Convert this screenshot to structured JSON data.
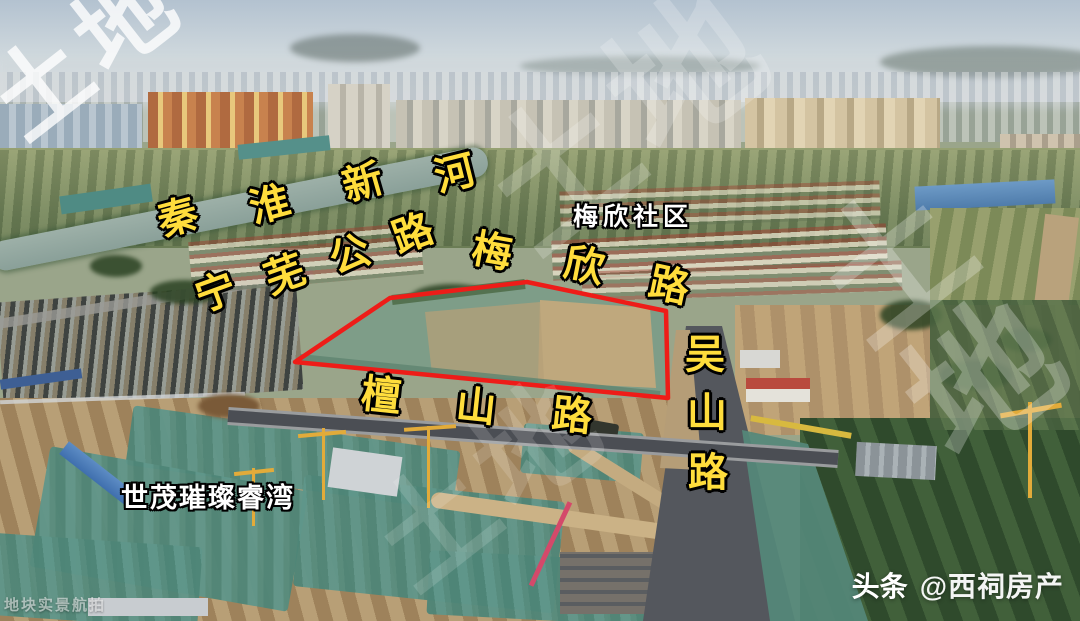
{
  "annotations": {
    "roads": [
      {
        "id": "qinhuai-xinhe",
        "text": "秦淮新河",
        "chars": [
          "秦",
          "淮",
          "新",
          "河"
        ]
      },
      {
        "id": "ningwu-highway",
        "text": "宁芜公路",
        "chars": [
          "宁",
          "芜",
          "公",
          "路"
        ]
      },
      {
        "id": "meixin-road",
        "text": "梅欣路",
        "chars": [
          "梅",
          "欣",
          "路"
        ]
      },
      {
        "id": "tanshan-road",
        "text": "檀山路",
        "chars": [
          "檀",
          "山",
          "路"
        ]
      },
      {
        "id": "wushan-road",
        "text": "吴山路",
        "chars": [
          "吴",
          "山",
          "路"
        ]
      }
    ],
    "places": [
      {
        "id": "meixin-community",
        "text": "梅欣社区"
      },
      {
        "id": "shimao-cuican-ruiwan",
        "text": "世茂璀璨睿湾"
      }
    ],
    "plot_outline_color": "#ee1c18",
    "road_label_color": "#ffdd3c"
  },
  "watermarks": {
    "diagonal_text": "土地",
    "corner_text": "地块实景航拍"
  },
  "credit": {
    "brand": "头条",
    "account": "@西祠房产"
  }
}
